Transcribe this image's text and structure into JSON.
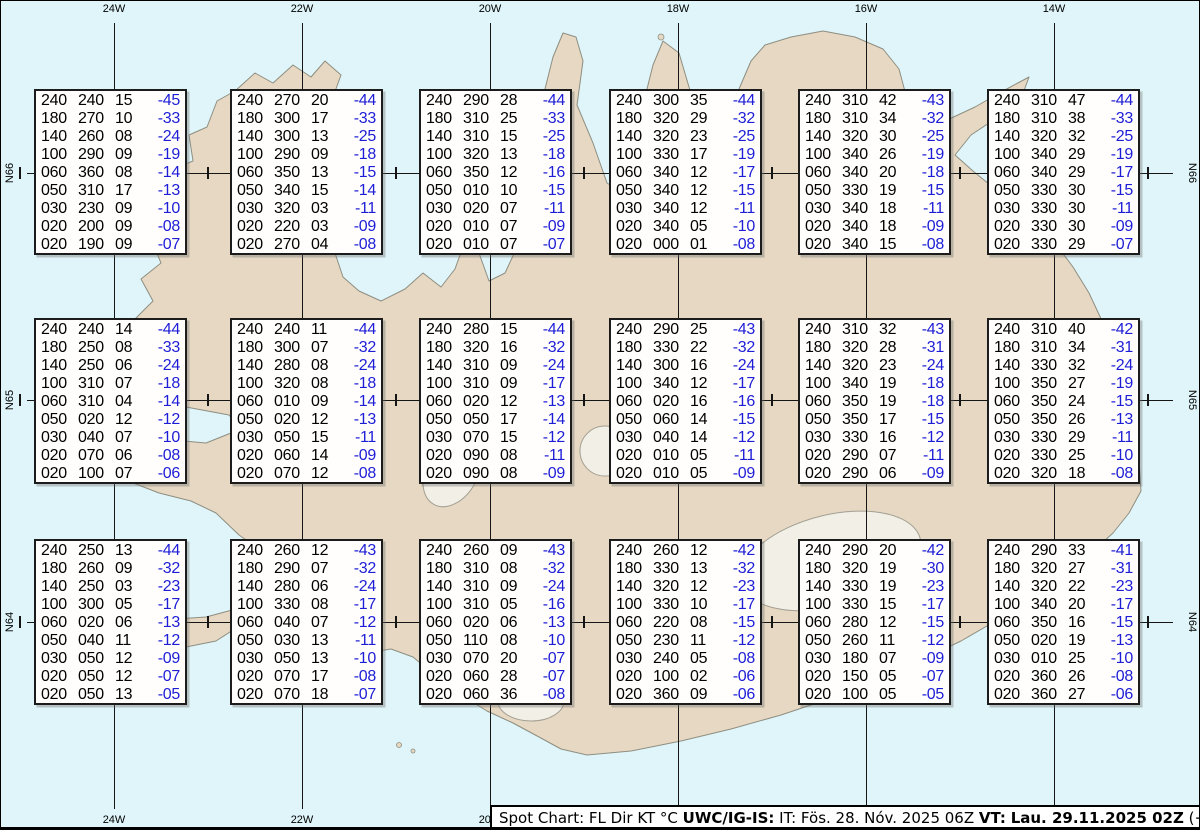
{
  "chart_data": {
    "type": "table",
    "title": "Spot Chart: FL Dir KT °C",
    "columns": [
      "FL",
      "Dir",
      "KT",
      "°C"
    ],
    "meridian_labels": [
      "24W",
      "22W",
      "20W",
      "18W",
      "16W",
      "14W"
    ],
    "parallel_labels": [
      "N66",
      "N65",
      "N64"
    ],
    "stations": [
      {
        "grid": "66N-24W",
        "rows": [
          [
            "240",
            "240",
            "15",
            "-45"
          ],
          [
            "180",
            "270",
            "10",
            "-33"
          ],
          [
            "140",
            "260",
            "08",
            "-24"
          ],
          [
            "100",
            "290",
            "09",
            "-19"
          ],
          [
            "060",
            "360",
            "08",
            "-14"
          ],
          [
            "050",
            "310",
            "17",
            "-13"
          ],
          [
            "030",
            "230",
            "09",
            "-10"
          ],
          [
            "020",
            "200",
            "09",
            "-08"
          ],
          [
            "020",
            "190",
            "09",
            "-07"
          ]
        ]
      },
      {
        "grid": "66N-22W",
        "rows": [
          [
            "240",
            "270",
            "20",
            "-44"
          ],
          [
            "180",
            "300",
            "17",
            "-33"
          ],
          [
            "140",
            "300",
            "13",
            "-25"
          ],
          [
            "100",
            "290",
            "09",
            "-18"
          ],
          [
            "060",
            "350",
            "13",
            "-15"
          ],
          [
            "050",
            "340",
            "15",
            "-14"
          ],
          [
            "030",
            "320",
            "03",
            "-11"
          ],
          [
            "020",
            "220",
            "03",
            "-09"
          ],
          [
            "020",
            "270",
            "04",
            "-08"
          ]
        ]
      },
      {
        "grid": "66N-20W",
        "rows": [
          [
            "240",
            "290",
            "28",
            "-44"
          ],
          [
            "180",
            "310",
            "25",
            "-33"
          ],
          [
            "140",
            "310",
            "15",
            "-25"
          ],
          [
            "100",
            "320",
            "13",
            "-18"
          ],
          [
            "060",
            "350",
            "12",
            "-16"
          ],
          [
            "050",
            "010",
            "10",
            "-15"
          ],
          [
            "030",
            "020",
            "07",
            "-11"
          ],
          [
            "020",
            "010",
            "07",
            "-09"
          ],
          [
            "020",
            "010",
            "07",
            "-07"
          ]
        ]
      },
      {
        "grid": "66N-18W",
        "rows": [
          [
            "240",
            "300",
            "35",
            "-44"
          ],
          [
            "180",
            "320",
            "29",
            "-32"
          ],
          [
            "140",
            "320",
            "23",
            "-25"
          ],
          [
            "100",
            "330",
            "17",
            "-19"
          ],
          [
            "060",
            "340",
            "12",
            "-17"
          ],
          [
            "050",
            "340",
            "12",
            "-15"
          ],
          [
            "030",
            "340",
            "12",
            "-11"
          ],
          [
            "020",
            "340",
            "05",
            "-10"
          ],
          [
            "020",
            "000",
            "01",
            "-08"
          ]
        ]
      },
      {
        "grid": "66N-16W",
        "rows": [
          [
            "240",
            "310",
            "42",
            "-43"
          ],
          [
            "180",
            "310",
            "34",
            "-32"
          ],
          [
            "140",
            "320",
            "30",
            "-25"
          ],
          [
            "100",
            "340",
            "26",
            "-19"
          ],
          [
            "060",
            "340",
            "20",
            "-18"
          ],
          [
            "050",
            "330",
            "19",
            "-15"
          ],
          [
            "030",
            "340",
            "18",
            "-11"
          ],
          [
            "020",
            "340",
            "18",
            "-09"
          ],
          [
            "020",
            "340",
            "15",
            "-08"
          ]
        ]
      },
      {
        "grid": "66N-14W",
        "rows": [
          [
            "240",
            "310",
            "47",
            "-44"
          ],
          [
            "180",
            "310",
            "38",
            "-33"
          ],
          [
            "140",
            "320",
            "32",
            "-25"
          ],
          [
            "100",
            "340",
            "29",
            "-19"
          ],
          [
            "060",
            "340",
            "29",
            "-17"
          ],
          [
            "050",
            "330",
            "30",
            "-15"
          ],
          [
            "030",
            "330",
            "30",
            "-11"
          ],
          [
            "020",
            "330",
            "30",
            "-09"
          ],
          [
            "020",
            "330",
            "29",
            "-07"
          ]
        ]
      },
      {
        "grid": "65N-24W",
        "rows": [
          [
            "240",
            "240",
            "14",
            "-44"
          ],
          [
            "180",
            "250",
            "08",
            "-33"
          ],
          [
            "140",
            "250",
            "06",
            "-24"
          ],
          [
            "100",
            "310",
            "07",
            "-18"
          ],
          [
            "060",
            "310",
            "04",
            "-14"
          ],
          [
            "050",
            "020",
            "12",
            "-12"
          ],
          [
            "030",
            "040",
            "07",
            "-10"
          ],
          [
            "020",
            "070",
            "06",
            "-08"
          ],
          [
            "020",
            "100",
            "07",
            "-06"
          ]
        ]
      },
      {
        "grid": "65N-22W",
        "rows": [
          [
            "240",
            "240",
            "11",
            "-44"
          ],
          [
            "180",
            "300",
            "07",
            "-32"
          ],
          [
            "140",
            "280",
            "08",
            "-24"
          ],
          [
            "100",
            "320",
            "08",
            "-18"
          ],
          [
            "060",
            "010",
            "09",
            "-14"
          ],
          [
            "050",
            "020",
            "12",
            "-13"
          ],
          [
            "030",
            "050",
            "15",
            "-11"
          ],
          [
            "020",
            "060",
            "14",
            "-09"
          ],
          [
            "020",
            "070",
            "12",
            "-08"
          ]
        ]
      },
      {
        "grid": "65N-20W",
        "rows": [
          [
            "240",
            "280",
            "15",
            "-44"
          ],
          [
            "180",
            "320",
            "16",
            "-32"
          ],
          [
            "140",
            "310",
            "09",
            "-24"
          ],
          [
            "100",
            "310",
            "09",
            "-17"
          ],
          [
            "060",
            "020",
            "12",
            "-13"
          ],
          [
            "050",
            "050",
            "17",
            "-14"
          ],
          [
            "030",
            "070",
            "15",
            "-12"
          ],
          [
            "020",
            "090",
            "08",
            "-11"
          ],
          [
            "020",
            "090",
            "08",
            "-09"
          ]
        ]
      },
      {
        "grid": "65N-18W",
        "rows": [
          [
            "240",
            "290",
            "25",
            "-43"
          ],
          [
            "180",
            "330",
            "22",
            "-32"
          ],
          [
            "140",
            "300",
            "16",
            "-24"
          ],
          [
            "100",
            "340",
            "12",
            "-17"
          ],
          [
            "060",
            "020",
            "16",
            "-16"
          ],
          [
            "050",
            "060",
            "14",
            "-15"
          ],
          [
            "030",
            "040",
            "14",
            "-12"
          ],
          [
            "020",
            "010",
            "05",
            "-11"
          ],
          [
            "020",
            "010",
            "05",
            "-09"
          ]
        ]
      },
      {
        "grid": "65N-16W",
        "rows": [
          [
            "240",
            "310",
            "32",
            "-43"
          ],
          [
            "180",
            "320",
            "28",
            "-31"
          ],
          [
            "140",
            "320",
            "23",
            "-24"
          ],
          [
            "100",
            "340",
            "19",
            "-18"
          ],
          [
            "060",
            "350",
            "19",
            "-18"
          ],
          [
            "050",
            "350",
            "17",
            "-15"
          ],
          [
            "030",
            "330",
            "16",
            "-12"
          ],
          [
            "020",
            "290",
            "07",
            "-11"
          ],
          [
            "020",
            "290",
            "06",
            "-09"
          ]
        ]
      },
      {
        "grid": "65N-14W",
        "rows": [
          [
            "240",
            "310",
            "40",
            "-42"
          ],
          [
            "180",
            "310",
            "34",
            "-31"
          ],
          [
            "140",
            "330",
            "32",
            "-24"
          ],
          [
            "100",
            "350",
            "27",
            "-19"
          ],
          [
            "060",
            "350",
            "24",
            "-15"
          ],
          [
            "050",
            "350",
            "26",
            "-13"
          ],
          [
            "030",
            "330",
            "29",
            "-11"
          ],
          [
            "020",
            "330",
            "25",
            "-10"
          ],
          [
            "020",
            "320",
            "18",
            "-08"
          ]
        ]
      },
      {
        "grid": "64N-24W",
        "rows": [
          [
            "240",
            "250",
            "13",
            "-44"
          ],
          [
            "180",
            "260",
            "09",
            "-32"
          ],
          [
            "140",
            "250",
            "03",
            "-23"
          ],
          [
            "100",
            "300",
            "05",
            "-17"
          ],
          [
            "060",
            "020",
            "06",
            "-13"
          ],
          [
            "050",
            "040",
            "11",
            "-12"
          ],
          [
            "030",
            "050",
            "12",
            "-09"
          ],
          [
            "020",
            "050",
            "12",
            "-07"
          ],
          [
            "020",
            "050",
            "13",
            "-05"
          ]
        ]
      },
      {
        "grid": "64N-22W",
        "rows": [
          [
            "240",
            "260",
            "12",
            "-43"
          ],
          [
            "180",
            "290",
            "07",
            "-32"
          ],
          [
            "140",
            "280",
            "06",
            "-24"
          ],
          [
            "100",
            "330",
            "08",
            "-17"
          ],
          [
            "060",
            "040",
            "07",
            "-12"
          ],
          [
            "050",
            "030",
            "13",
            "-11"
          ],
          [
            "030",
            "050",
            "13",
            "-10"
          ],
          [
            "020",
            "070",
            "17",
            "-08"
          ],
          [
            "020",
            "070",
            "18",
            "-07"
          ]
        ]
      },
      {
        "grid": "64N-20W",
        "rows": [
          [
            "240",
            "260",
            "09",
            "-43"
          ],
          [
            "180",
            "310",
            "08",
            "-32"
          ],
          [
            "140",
            "310",
            "09",
            "-24"
          ],
          [
            "100",
            "310",
            "05",
            "-16"
          ],
          [
            "060",
            "020",
            "06",
            "-13"
          ],
          [
            "050",
            "110",
            "08",
            "-10"
          ],
          [
            "030",
            "070",
            "20",
            "-07"
          ],
          [
            "020",
            "060",
            "28",
            "-07"
          ],
          [
            "020",
            "060",
            "36",
            "-08"
          ]
        ]
      },
      {
        "grid": "64N-18W",
        "rows": [
          [
            "240",
            "260",
            "12",
            "-42"
          ],
          [
            "180",
            "330",
            "13",
            "-32"
          ],
          [
            "140",
            "320",
            "12",
            "-23"
          ],
          [
            "100",
            "330",
            "10",
            "-17"
          ],
          [
            "060",
            "220",
            "08",
            "-15"
          ],
          [
            "050",
            "230",
            "11",
            "-12"
          ],
          [
            "030",
            "240",
            "05",
            "-08"
          ],
          [
            "020",
            "100",
            "02",
            "-06"
          ],
          [
            "020",
            "360",
            "09",
            "-06"
          ]
        ]
      },
      {
        "grid": "64N-16W",
        "rows": [
          [
            "240",
            "290",
            "20",
            "-42"
          ],
          [
            "180",
            "320",
            "19",
            "-30"
          ],
          [
            "140",
            "330",
            "19",
            "-23"
          ],
          [
            "100",
            "330",
            "15",
            "-17"
          ],
          [
            "060",
            "280",
            "12",
            "-15"
          ],
          [
            "050",
            "260",
            "11",
            "-12"
          ],
          [
            "030",
            "180",
            "07",
            "-09"
          ],
          [
            "020",
            "150",
            "05",
            "-07"
          ],
          [
            "020",
            "100",
            "05",
            "-05"
          ]
        ]
      },
      {
        "grid": "64N-14W",
        "rows": [
          [
            "240",
            "290",
            "33",
            "-41"
          ],
          [
            "180",
            "320",
            "27",
            "-31"
          ],
          [
            "140",
            "320",
            "22",
            "-23"
          ],
          [
            "100",
            "340",
            "20",
            "-17"
          ],
          [
            "060",
            "350",
            "16",
            "-15"
          ],
          [
            "050",
            "020",
            "19",
            "-13"
          ],
          [
            "030",
            "010",
            "25",
            "-10"
          ],
          [
            "020",
            "360",
            "26",
            "-08"
          ],
          [
            "020",
            "360",
            "27",
            "-06"
          ]
        ]
      }
    ]
  },
  "footer": {
    "segments": [
      {
        "text": "Spot Chart: FL Dir KT °C ",
        "bold": false
      },
      {
        "text": "UWC/IG-IS:",
        "bold": true
      },
      {
        "text": " IT: Fös. 28. Nóv. 2025 06Z ",
        "bold": false
      },
      {
        "text": "VT:",
        "bold": true
      },
      {
        "text": " ",
        "bold": false
      },
      {
        "text": "Lau. 29.11.2025 02Z",
        "bold": true
      },
      {
        "text": " (+20 h)",
        "bold": false
      }
    ]
  },
  "colors": {
    "water": "#dff5f9",
    "land": "#e6d8c2",
    "glacier": "#f1efe6",
    "temp_blue": "#1d1dd6",
    "text_black": "#000000"
  }
}
